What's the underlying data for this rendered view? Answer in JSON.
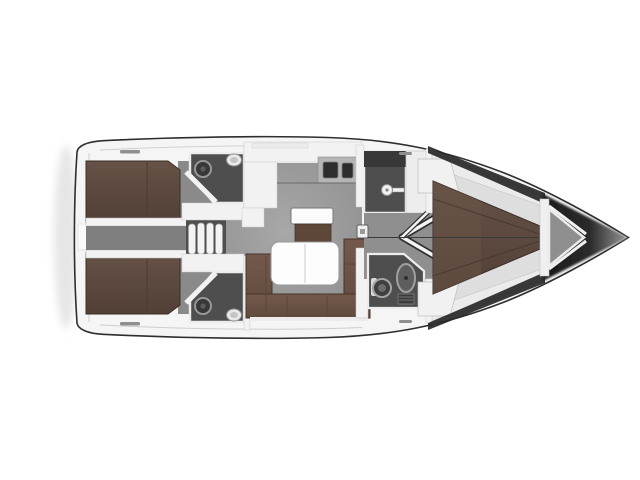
{
  "scene": {
    "type": "sailboat-interior-floor-plan",
    "view": "top-down",
    "orientation": "bow-right"
  },
  "colors": {
    "background": "#ffffff",
    "hull_outline": "#2e2e2e",
    "hull_white": "#f5f5f5",
    "rim_line": "#cdcdcd",
    "shadow_soft": "#e6e6e6",
    "floor": "#9b9b9b",
    "cabin_floor": "#8a8a8a",
    "corridor": "#7f7f7f",
    "fwd_corridor": "#8f8f8f",
    "fwd_cabin_base": "#dedede",
    "head_floor": "#4e4e4e",
    "head_floor_dark": "#383838",
    "berth_brown": "#5e4a40",
    "berth_brown_light": "#6a5348",
    "sofa_brown": "#6e5649",
    "seat_brown": "#5d4739",
    "seam_dark": "#4a3a31",
    "wall_white": "#f2f2f2",
    "wall_edge": "#bdbdbd",
    "counter_steel": "#b5b5b5",
    "sink_dark": "#2d2d2d",
    "table_white": "#fdfdfd",
    "steps_white": "#f3f3f3",
    "steps_well": "#4f4f4f",
    "fixture_light": "#e9e9e9",
    "fixture_dark": "#3f3f3f",
    "fixture_ring": "#a0a0a0",
    "locker_gray": "#8f8f8f",
    "bow_shade": "#282828",
    "bow_tip_dark": "#1a1a1a",
    "bow_tip_fade": "#979797",
    "detail_dark": "#555555",
    "cleat_gray": "#8f8f8f"
  }
}
